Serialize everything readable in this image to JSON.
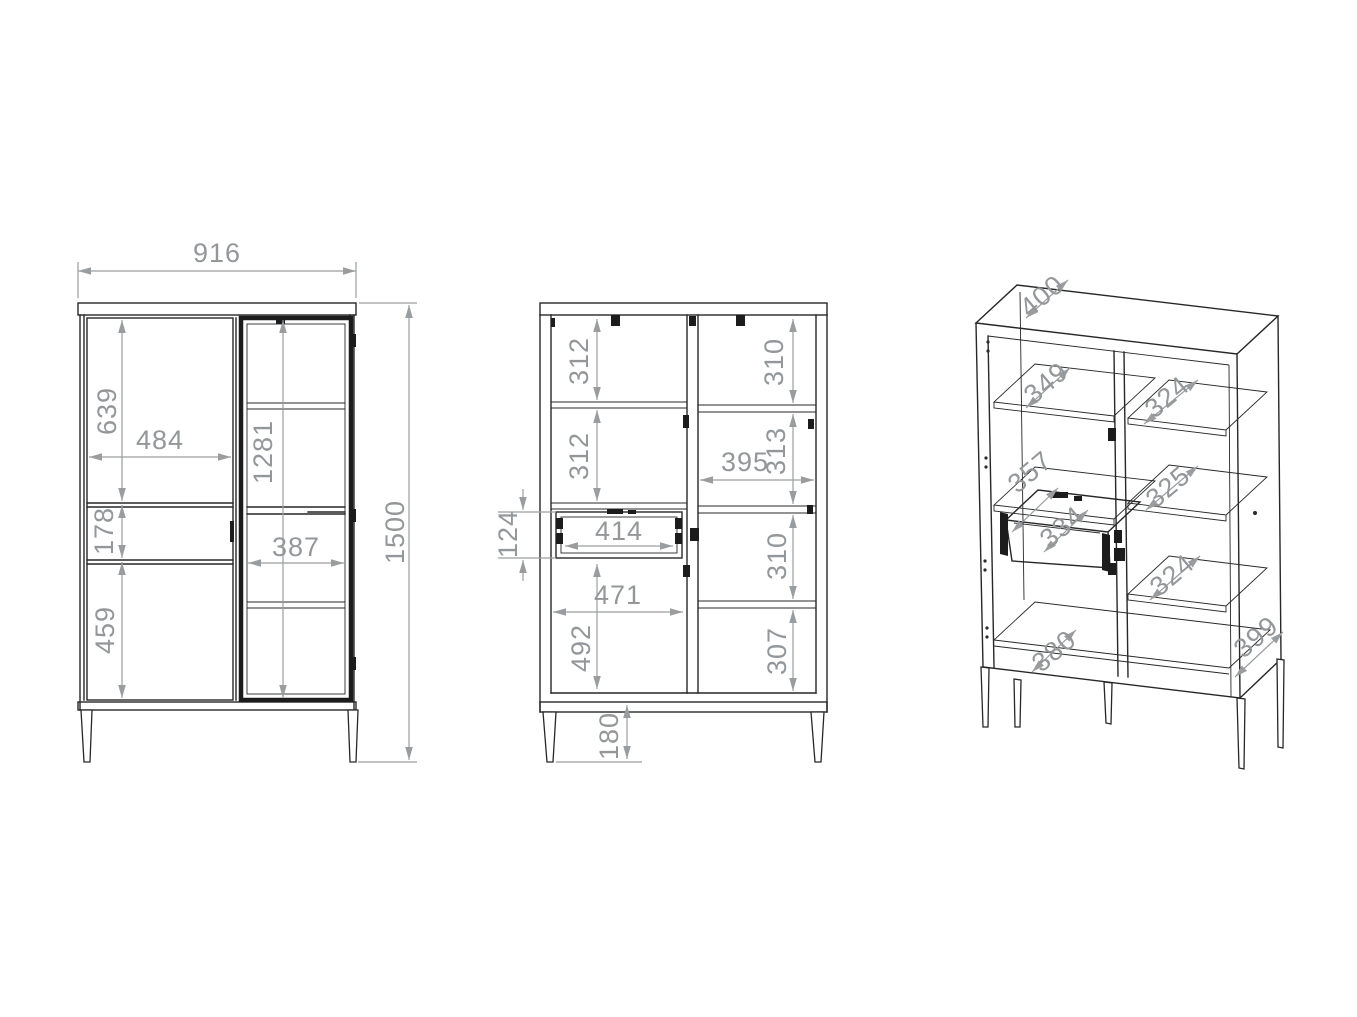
{
  "drawing": {
    "type": "furniture-technical-drawing",
    "units": "mm"
  },
  "views": {
    "front": {
      "overall_width": "916",
      "overall_height": "1500",
      "upper_door_height": "639",
      "door_width": "484",
      "drawer_front_height": "178",
      "lower_door_height": "459",
      "glass_door_height": "1281",
      "glass_door_width": "387"
    },
    "internal": {
      "left_top_section_height": "312",
      "left_middle_section_height": "312",
      "drawer_height": "124",
      "drawer_width": "414",
      "lower_cavity_width": "471",
      "lower_cavity_height": "492",
      "leg_height": "180",
      "right_top_section_height": "310",
      "right_second_section_height": "313",
      "right_cavity_width": "395",
      "right_third_section_height": "310",
      "right_bottom_section_height": "307"
    },
    "isometric": {
      "top_depth": "400",
      "left_shelf_top_depth": "349",
      "left_shelf_middle_depth": "357",
      "drawer_depth": "334",
      "bottom_shelf_depth": "380",
      "right_shelf_top_depth": "324",
      "right_shelf_middle_depth": "325",
      "right_shelf_bottom_depth": "324",
      "side_depth": "399"
    }
  },
  "colors": {
    "background": "#ffffff",
    "outline": "#272727",
    "dimension": "#9a9da0"
  }
}
